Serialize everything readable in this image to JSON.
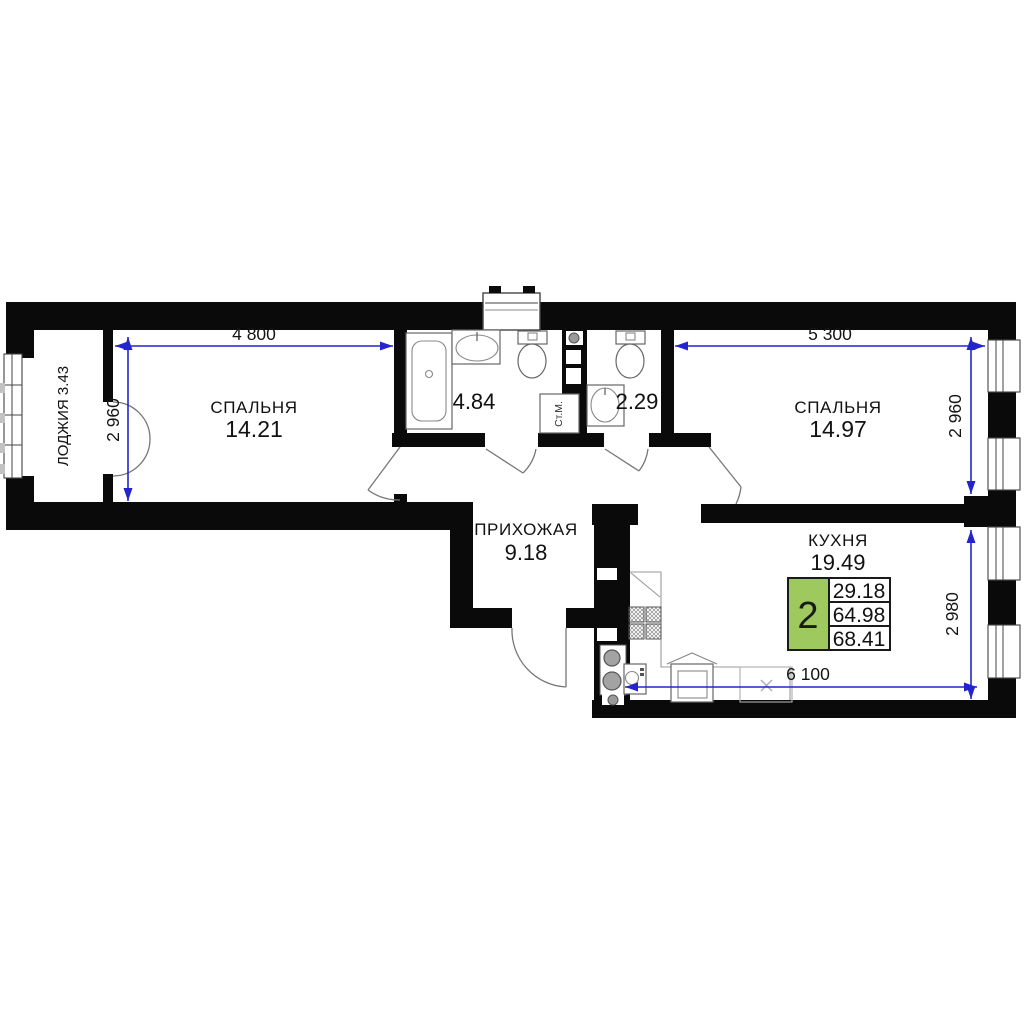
{
  "plan": {
    "rooms": {
      "loggia": {
        "label": "ЛОДЖИЯ 3.43"
      },
      "bedroom1": {
        "name": "СПАЛЬНЯ",
        "area": "14.21"
      },
      "bathroom": {
        "area": "4.84"
      },
      "wc": {
        "area": "2.29"
      },
      "bedroom2": {
        "name": "СПАЛЬНЯ",
        "area": "14.97"
      },
      "hallway": {
        "name": "ПРИХОЖАЯ",
        "area": "9.18"
      },
      "kitchen": {
        "name": "КУХНЯ",
        "area": "19.49"
      }
    },
    "fixtures": {
      "washing_machine_label": "Ст.М."
    },
    "dimensions": {
      "bedroom1_width": "4 800",
      "bedroom1_depth": "2 960",
      "bedroom2_width": "5 300",
      "bedroom2_depth": "2 960",
      "kitchen_depth": "2 980",
      "kitchen_width": "6 100"
    },
    "info_badge": {
      "rooms_count": "2",
      "values": [
        "29.18",
        "64.98",
        "68.41"
      ]
    },
    "colors": {
      "badge_green": "#9dc95e",
      "dimension_blue": "#2424cf",
      "wall_black": "#0a0a0a"
    }
  }
}
